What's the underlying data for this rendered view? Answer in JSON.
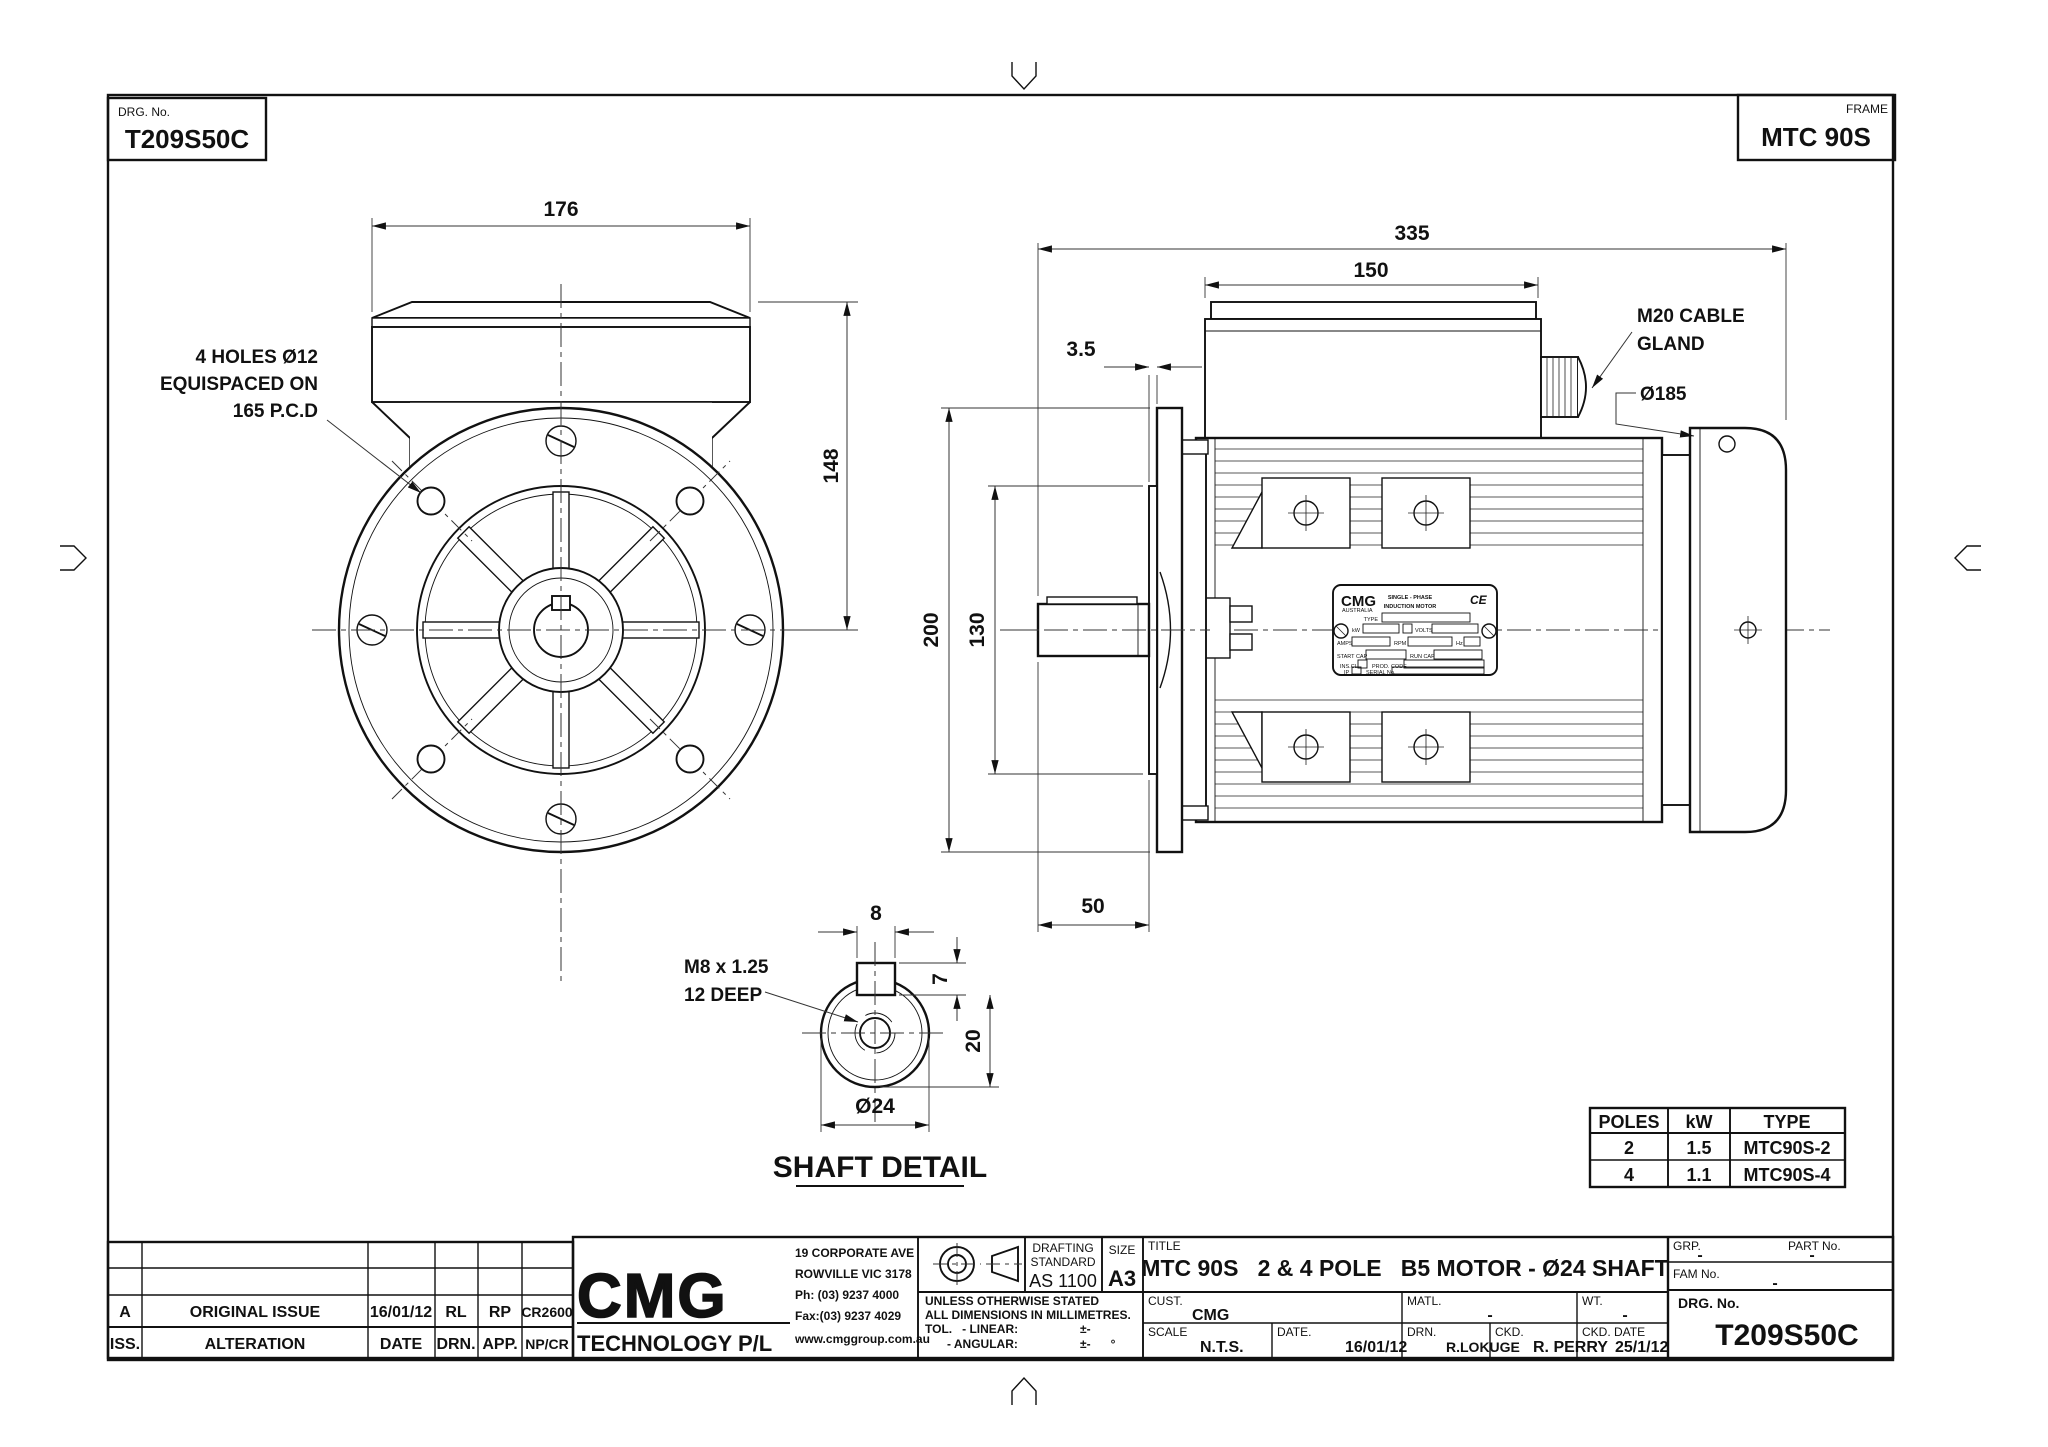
{
  "sheet": {
    "drg_label": "DRG. No.",
    "drg_no": "T209S50C",
    "frame_label": "FRAME",
    "frame_value": "MTC 90S"
  },
  "front_view": {
    "dim_width": "176",
    "dim_height": "148",
    "note1": "4 HOLES Ø12",
    "note2": "EQUISPACED ON",
    "note3": "165 P.C.D"
  },
  "side_view": {
    "dim_overall": "335",
    "dim_box_w": "150",
    "dim_spigot": "3.5",
    "dim_flange_od": "200",
    "dim_register": "130",
    "dim_shaft": "50",
    "gland1": "M20 CABLE",
    "gland2": "GLAND",
    "cowl_dia": "Ø185"
  },
  "nameplate": {
    "brand": "CMG",
    "brand_sub": "AUSTRALIA",
    "line1": "SINGLE - PHASE",
    "line2": "INDUCTION MOTOR",
    "ce": "CE",
    "type": "TYPE",
    "kw": "kW",
    "volts": "VOLTS",
    "amps": "AMPS",
    "rpm": "RPM",
    "hz": "Hz",
    "start_cap": "START CAP",
    "run_cap": "RUN CAP",
    "ins_cl": "INS.CL",
    "prod_code": "PROD. CODE",
    "ip": "IP",
    "serial": "SERIAL No."
  },
  "shaft_detail": {
    "title": "SHAFT DETAIL",
    "key_w": "8",
    "key_d": "7",
    "flat": "20",
    "dia": "Ø24",
    "note1": "M8 x 1.25",
    "note2": "12 DEEP"
  },
  "ratings_table": {
    "headers": [
      "POLES",
      "kW",
      "TYPE"
    ],
    "rows": [
      [
        "2",
        "1.5",
        "MTC90S-2"
      ],
      [
        "4",
        "1.1",
        "MTC90S-4"
      ]
    ]
  },
  "revision_table": {
    "row_a": [
      "A",
      "ORIGINAL ISSUE",
      "16/01/12",
      "RL",
      "RP",
      "CR2600"
    ],
    "headers": [
      "ISS.",
      "ALTERATION",
      "DATE",
      "DRN.",
      "APP.",
      "NP/CR"
    ]
  },
  "title_block": {
    "logo": "CMG",
    "company": "TECHNOLOGY P/L",
    "addr1": "19 CORPORATE AVE",
    "addr2": "ROWVILLE VIC 3178",
    "addr3": "Ph: (03) 9237 4000",
    "addr4": "Fax:(03) 9237 4029",
    "addr5": "www.cmggroup.com.au",
    "drafting1": "DRAFTING",
    "drafting2": "STANDARD",
    "drafting3": "AS 1100",
    "size_label": "SIZE",
    "size_value": "A3",
    "tol1": "UNLESS OTHERWISE STATED",
    "tol2": "ALL DIMENSIONS IN MILLIMETRES.",
    "tol3": "TOL.   - LINEAR:",
    "tol4": "- ANGULAR:",
    "tol_lin_val": "±-",
    "tol_ang_val": "±-      °",
    "title_label": "TITLE",
    "title": "MTC 90S   2 & 4 POLE   B5 MOTOR - Ø24 SHAFT",
    "cust_label": "CUST.",
    "cust": "CMG",
    "matl_label": "MATL.",
    "matl": "-",
    "wt_label": "WT.",
    "wt": "-",
    "scale_label": "SCALE",
    "scale": "N.T.S.",
    "date_label": "DATE.",
    "date": "16/01/12",
    "drn_label": "DRN.",
    "drn": "R.LOKUGE",
    "ckd_label": "CKD.",
    "ckd": "R. PERRY",
    "ckd_date_label": "CKD. DATE",
    "ckd_date": "25/1/12",
    "grp_label": "GRP.",
    "grp": "-",
    "part_label": "PART No.",
    "part": "-",
    "fam_label": "FAM No.",
    "fam": "-",
    "drg_label": "DRG. No.",
    "drg_no": "T209S50C"
  }
}
